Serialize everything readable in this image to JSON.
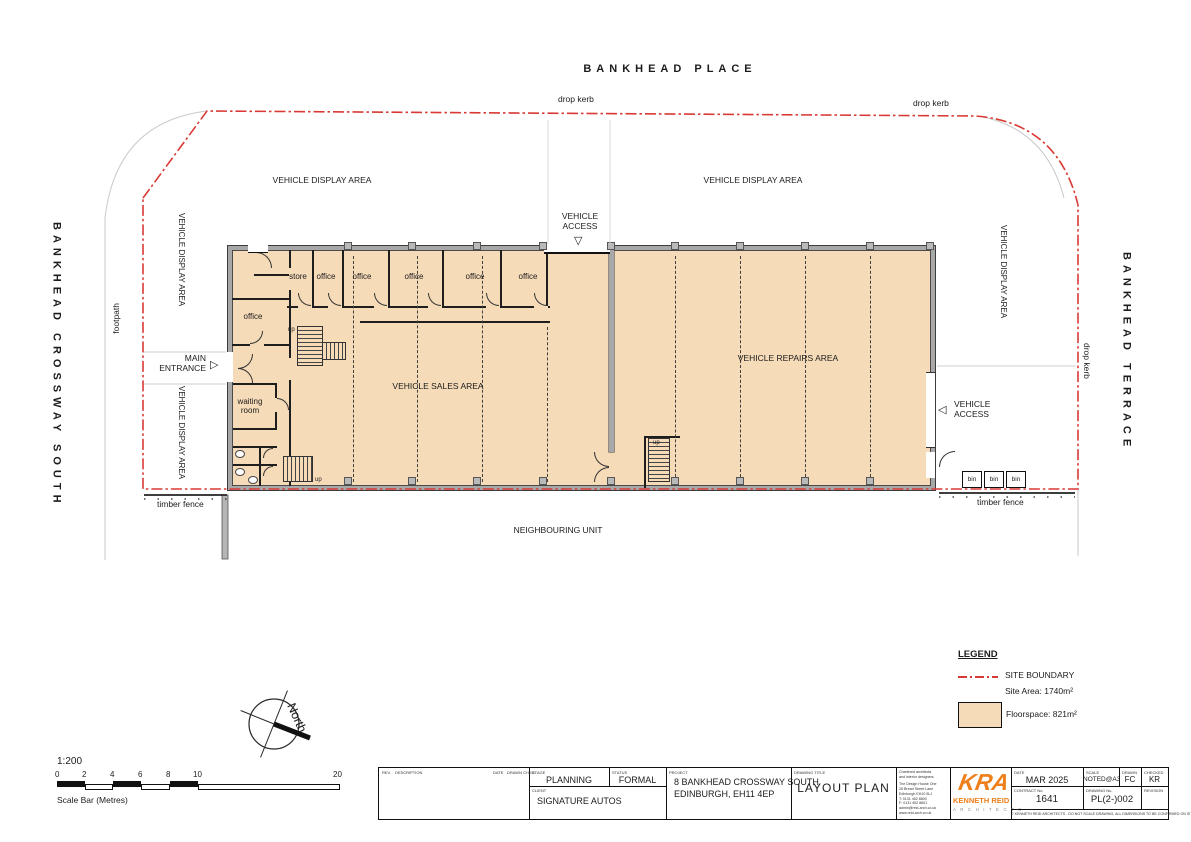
{
  "streets": {
    "top": "BANKHEAD PLACE",
    "left": "BANKHEAD CROSSWAY SOUTH",
    "right": "BANKHEAD TERRACE"
  },
  "site": {
    "drop_kerb": "drop kerb",
    "footpath": "footpath",
    "vehicle_display_area": "VEHICLE DISPLAY AREA",
    "vehicle_access_line1": "VEHICLE",
    "vehicle_access_line2": "ACCESS",
    "main_entrance_line1": "MAIN",
    "main_entrance_line2": "ENTRANCE",
    "timber_fence": "timber fence",
    "neighbouring_unit": "NEIGHBOURING UNIT",
    "bin": "bin"
  },
  "building": {
    "vehicle_sales_area": "VEHICLE SALES AREA",
    "vehicle_repairs_area": "VEHICLE REPAIRS AREA",
    "store": "store",
    "office": "office",
    "waiting_room_line1": "waiting",
    "waiting_room_line2": "room",
    "up": "up"
  },
  "legend": {
    "title": "LEGEND",
    "site_boundary_label": "SITE BOUNDARY",
    "site_area": "Site Area: 1740m²",
    "floorspace": "Floorspace: 821m²"
  },
  "compass": {
    "north": "North"
  },
  "scalebar": {
    "ratio": "1:200",
    "ticks": [
      "0",
      "2",
      "4",
      "6",
      "8",
      "10",
      "20"
    ],
    "caption": "Scale Bar (Metres)"
  },
  "titleblock": {
    "rev_header": "REV.",
    "description_header": "DESCRIPTION",
    "date_col_header": "DATE",
    "drawn_chkd_header": "DRAWN  CHKD.",
    "stage_label": "STAGE",
    "stage": "PLANNING",
    "status_label": "STATUS",
    "status": "FORMAL",
    "client_label": "CLIENT",
    "client": "SIGNATURE AUTOS",
    "project_label": "PROJECT",
    "project_line1": "8 BANKHEAD CROSSWAY SOUTH",
    "project_line2": "EDINBURGH, EH11 4EP",
    "drawing_title_label": "DRAWING TITLE",
    "drawing_title": "LAYOUT PLAN",
    "company_lines": [
      "Chartered architects",
      "and interior designers",
      "The Design House One",
      "26 Bread Street Lane",
      "Edinburgh EH10 5LJ",
      "T: 0131 452 8800",
      "F: 0131 452 8801",
      "admin@reid-arch.co.uk",
      "www.reid-arch.co.uk"
    ],
    "logo_kra": "KRA",
    "logo_name": "KENNETH REID",
    "logo_sub": "A R C H I T E C T S",
    "date_label": "DATE",
    "date": "MAR 2025",
    "scale_label": "SCALE",
    "scale": "NOTED@A3",
    "drawn_label": "DRAWN",
    "drawn": "FC",
    "checked_label": "CHECKED",
    "checked": "KR",
    "contract_label": "CONTRACT No.",
    "contract": "1641",
    "drawing_no_label": "DRAWING No.",
    "drawing_no": "PL(2-)002",
    "revision_label": "REVISION",
    "copyright": "© KENNETH REID ARCHITECTS - DO NOT SCALE DRAWING, ALL DIMENSIONS TO BE CONFIRMED ON SITE"
  },
  "colors": {
    "floorspace_fill": "#f6dbb8",
    "site_boundary": "#d93a35",
    "wall_grey": "#a8a8a8",
    "logo_orange": "#ee7f1b"
  }
}
